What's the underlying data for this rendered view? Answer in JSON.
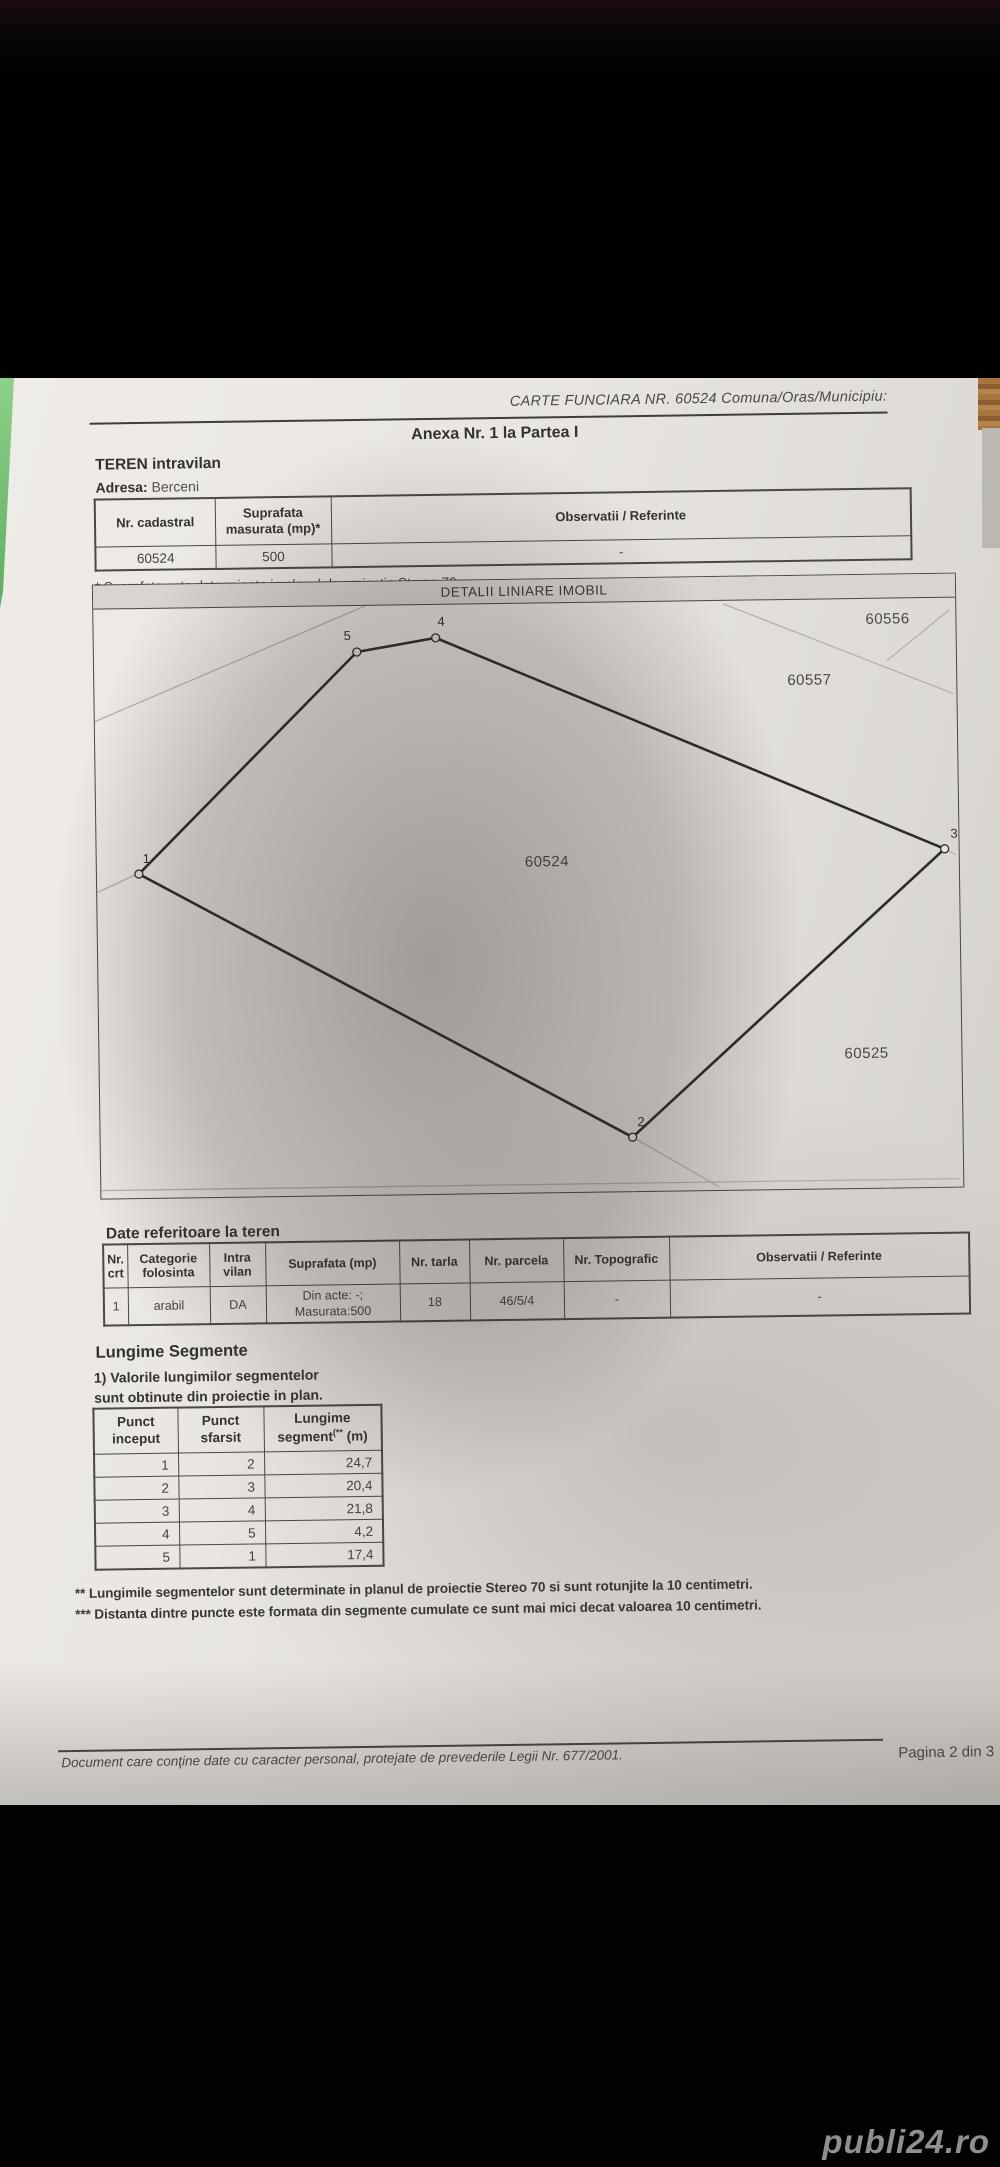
{
  "header": {
    "carte_funciara": "CARTE FUNCIARA NR. 60524 Comuna/Oras/Municipiu:",
    "anexa": "Anexa Nr. 1 la Partea I"
  },
  "teren_section": {
    "title": "TEREN intravilan",
    "address_label": "Adresa:",
    "address_value": "Berceni",
    "table": {
      "col1": "Nr. cadastral",
      "col2": "Suprafata masurata (mp)*",
      "col3": "Observatii / Referinte",
      "row": {
        "nr_cadastral": "60524",
        "suprafata": "500",
        "observatii": "-"
      }
    },
    "footnote": "* Suprafata este determinata in planul de proiectie Stereo 70."
  },
  "map": {
    "title": "DETALII LINIARE IMOBIL",
    "parcel_labels": [
      {
        "text": "60556"
      },
      {
        "text": "60557"
      },
      {
        "text": "60524"
      },
      {
        "text": "60525"
      }
    ],
    "points": [
      {
        "n": "1"
      },
      {
        "n": "2"
      },
      {
        "n": "3"
      },
      {
        "n": "4"
      },
      {
        "n": "5"
      }
    ]
  },
  "date_teren": {
    "title": "Date referitoare la teren",
    "headers": [
      "Nr. crt",
      "Categorie folosinta",
      "Intra vilan",
      "Suprafata (mp)",
      "Nr. tarla",
      "Nr. parcela",
      "Nr. Topografic",
      "Observatii / Referinte"
    ],
    "row": {
      "nr": "1",
      "categorie": "arabil",
      "intravilan": "DA",
      "din_acte": "Din acte: -;",
      "masurata": "Masurata:500",
      "tarla": "18",
      "parcela": "46/5/4",
      "topografic": "-",
      "observatii": "-"
    }
  },
  "segmente": {
    "title": "Lungime Segmente",
    "note_line1": "1) Valorile lungimilor segmentelor",
    "note_line2": "sunt obtinute din proiectie in plan.",
    "col_start": "Punct inceput",
    "col_end": "Punct sfarsit",
    "col_len_main": "Lungime segment",
    "col_len_sup": "(**",
    "col_len_unit": " (m)",
    "rows": [
      [
        "1",
        "2",
        "24,7"
      ],
      [
        "2",
        "3",
        "20,4"
      ],
      [
        "3",
        "4",
        "21,8"
      ],
      [
        "4",
        "5",
        "4,2"
      ],
      [
        "5",
        "1",
        "17,4"
      ]
    ],
    "footnote2": "** Lungimile segmentelor sunt determinate in planul de proiectie Stereo 70 si sunt rotunjite la 10 centimetri.",
    "footnote3": "*** Distanta dintre puncte este formata din segmente cumulate ce sunt mai mici decat valoarea 10 centimetri."
  },
  "footer": {
    "privacy": "Document care conţine date cu caracter personal, protejate de prevederile Legii Nr. 677/2001.",
    "page": "Pagina 2 din 3"
  },
  "watermark": "publi24.ro",
  "colors": {
    "paper": "#e8e5e0",
    "ink": "#3c3a36",
    "green_edge": "#7cc87f",
    "watermark": "#8f8f8f"
  }
}
